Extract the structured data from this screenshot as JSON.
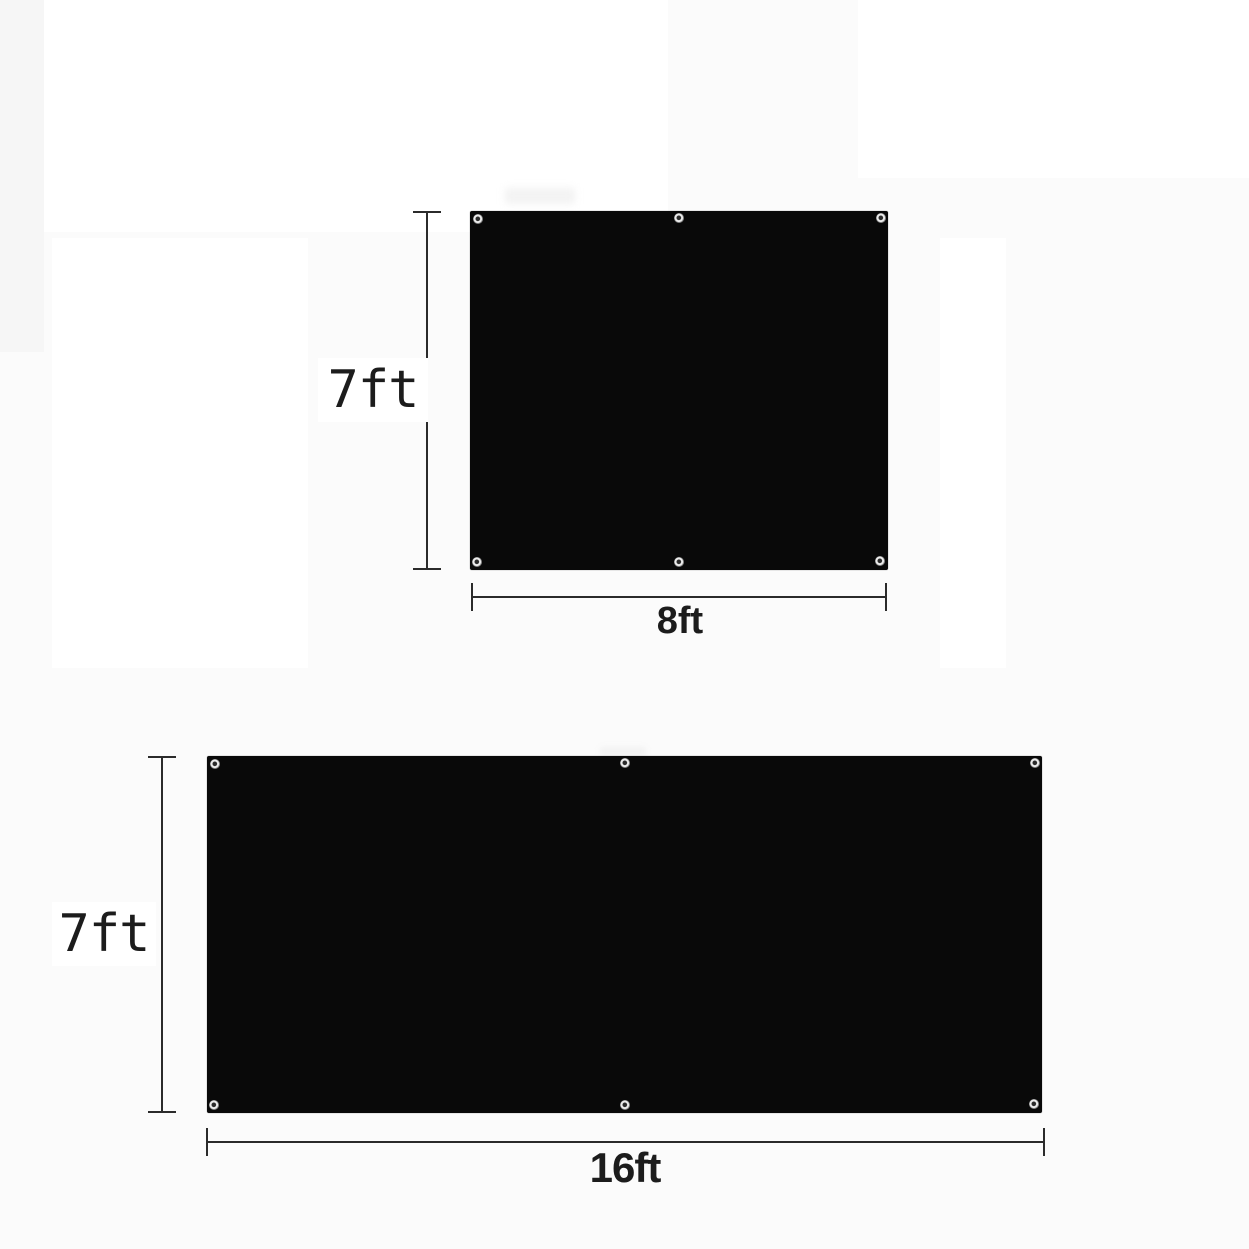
{
  "diagram": {
    "type": "product-dimension-diagram",
    "figures": [
      {
        "name": "panel-7x8",
        "height_label": "7ft",
        "width_label": "8ft",
        "grommet_count": 6
      },
      {
        "name": "panel-7x16",
        "height_label": "7ft",
        "width_label": "16ft",
        "grommet_count": 6
      }
    ]
  },
  "colors": {
    "panel_black": "#090909",
    "dimension_line": "#2b2b2b",
    "label_text": "#1c1c1c",
    "background": "#fbfbfb",
    "label_background": "#ffffff"
  }
}
